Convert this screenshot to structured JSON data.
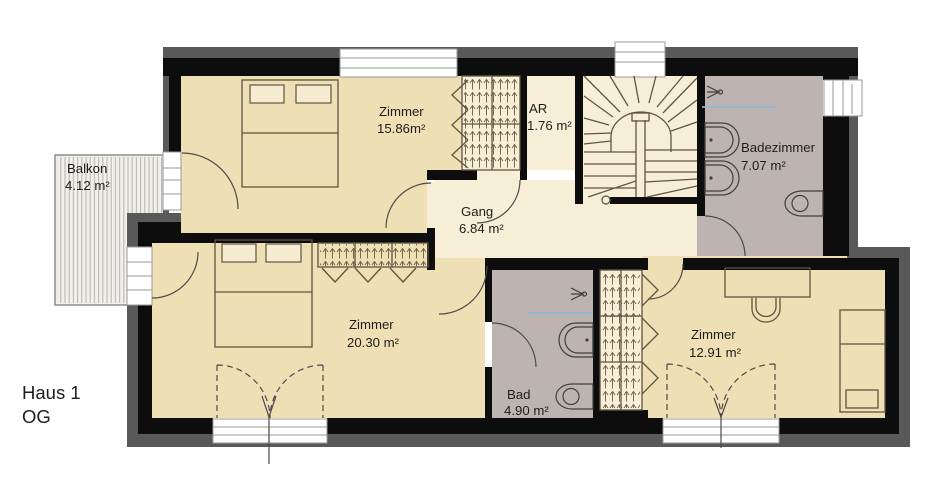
{
  "title": {
    "name": "Haus 1",
    "floor": "OG"
  },
  "rooms": {
    "balkon": {
      "name": "Balkon",
      "area": "4.12 m²"
    },
    "zimmer_nw": {
      "name": "Zimmer",
      "area": "15.86m²"
    },
    "ar": {
      "name": "AR",
      "area": "1.76 m²"
    },
    "gang": {
      "name": "Gang",
      "area": "6.84 m²"
    },
    "badezimmer": {
      "name": "Badezimmer",
      "area": "7.07 m²"
    },
    "zimmer_sw": {
      "name": "Zimmer",
      "area": "20.30 m²"
    },
    "bad": {
      "name": "Bad",
      "area": "4.90 m²"
    },
    "zimmer_se": {
      "name": "Zimmer",
      "area": "12.91 m²"
    }
  },
  "colors": {
    "wall": "#0d0d0d",
    "outer": "#595959",
    "floor": "#eedfb4",
    "floor-light": "#f7eed8",
    "wet": "#bdb4b2",
    "balcony-bg": "#f2f0ed",
    "glass": "#8fb9d6",
    "furniture": "#5f5541",
    "door-arc": "#4b4b4b",
    "frame": "#9a9a9a",
    "text": "#1d1d1d"
  }
}
